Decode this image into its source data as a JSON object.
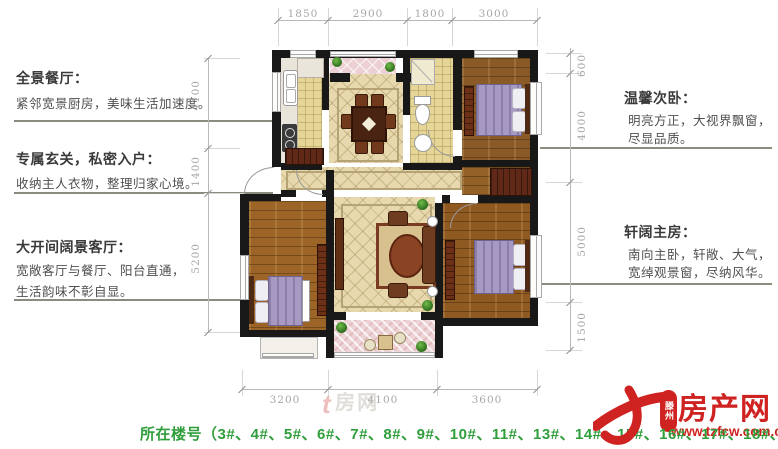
{
  "left_notes": [
    {
      "title": "全景餐厅：",
      "lines": [
        "紧邻宽景厨房，美味生活加速度。"
      ]
    },
    {
      "title": "专属玄关，私密入户：",
      "lines": [
        "收纳主人衣物，整理归家心境。"
      ]
    },
    {
      "title": "大开间阔景客厅：",
      "lines": [
        "宽敞客厅与餐厅、阳台直通，",
        "生活韵味不彰自显。"
      ]
    }
  ],
  "right_notes": [
    {
      "title": "温馨次卧：",
      "lines": [
        "明亮方正，大视界飘窗，",
        "尽显品质。"
      ]
    },
    {
      "title": "轩阔主房：",
      "lines": [
        "南向主卧，轩敞、大气，",
        "宽绰观景窗，尽纳风华。"
      ]
    }
  ],
  "dimensions": {
    "top": [
      "1850",
      "2900",
      "1800",
      "3000"
    ],
    "bottom": [
      "3200",
      "4100",
      "3600"
    ],
    "left": [
      "4100",
      "1400",
      "5200"
    ],
    "right": [
      "600",
      "4000",
      "5000",
      "1500"
    ]
  },
  "footer": {
    "building_numbers": "所在楼号（3#、4#、5#、6#、7#、8#、9#、10#、11#、13#、14#、15#、16#、17#、18#、19#）"
  },
  "logo": {
    "region": "滕州",
    "name": "房产网",
    "url": "www.tzfcw.com.cn"
  },
  "watermark": {
    "text": "房网"
  },
  "colors": {
    "accent_red": "#cf2321",
    "footer_green": "#2f9e3b"
  }
}
